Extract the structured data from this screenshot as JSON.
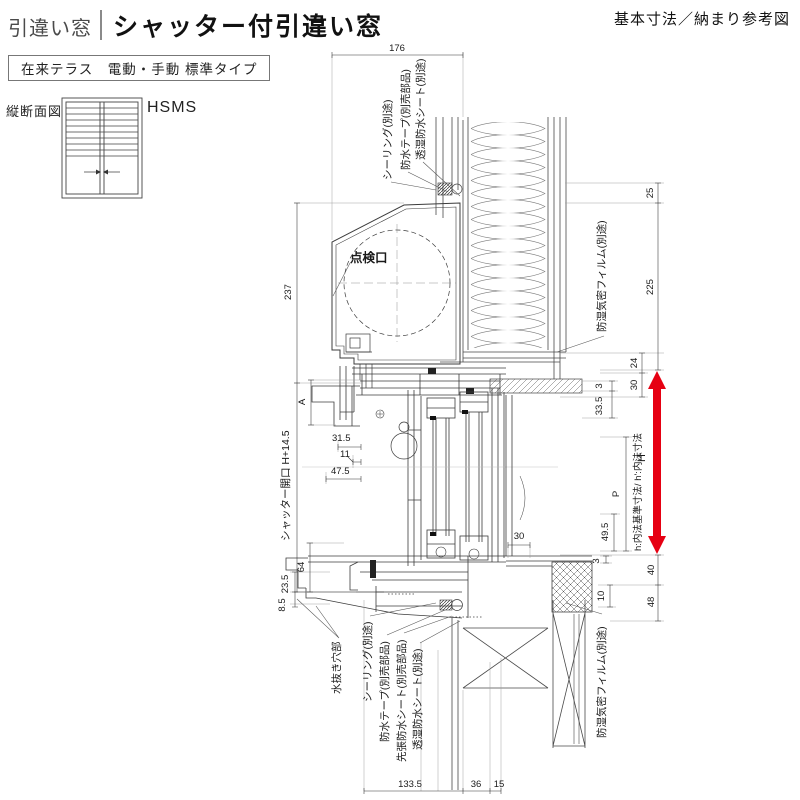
{
  "header": {
    "category_label": "引違い窓",
    "title": "シャッター付引違い窓",
    "top_right_note": "基本寸法／納まり参考図",
    "type_box": "在来テラス　電動・手動 標準タイプ"
  },
  "thumbnail": {
    "label": "縦断面図",
    "code": "HSMS"
  },
  "callouts": {
    "sealing_top": "シーリング(別途)",
    "tape_top": "防水テープ(別売部品)",
    "sheet_top": "透湿防水シート(別途)",
    "film_top": "防湿気密フィルム(別途)",
    "film_bottom": "防湿気密フィルム(別途)",
    "inspection": "点検口",
    "drain": "水抜き穴部",
    "sealing_bottom": "シーリング(別途)",
    "tape_bottom": "防水テープ(別売部品)",
    "presheet_bottom": "先張防水シート(別売部品)",
    "sheet_bottom": "透湿防水シート(別途)",
    "shutter_opening": "シャッター開口 H+14.5",
    "inner_note": "h:内法基準寸法/ h':内法寸法"
  },
  "dims": {
    "w176": "176",
    "h237": "237",
    "A": "A",
    "d315": "31.5",
    "d11": "11",
    "d475": "47.5",
    "d64": "64",
    "d235": "23.5",
    "d85": "8.5",
    "d25": "25",
    "d225": "225",
    "H": "H",
    "d40": "40",
    "d48": "48",
    "d24": "24",
    "d30": "30",
    "d3a": "3",
    "d335": "33.5",
    "P": "P",
    "d495": "49.5",
    "d3b": "3",
    "d10": "10",
    "d30b": "30",
    "d1335": "133.5",
    "d36": "36",
    "d15": "15"
  },
  "colors": {
    "accent_red": "#e60012"
  }
}
